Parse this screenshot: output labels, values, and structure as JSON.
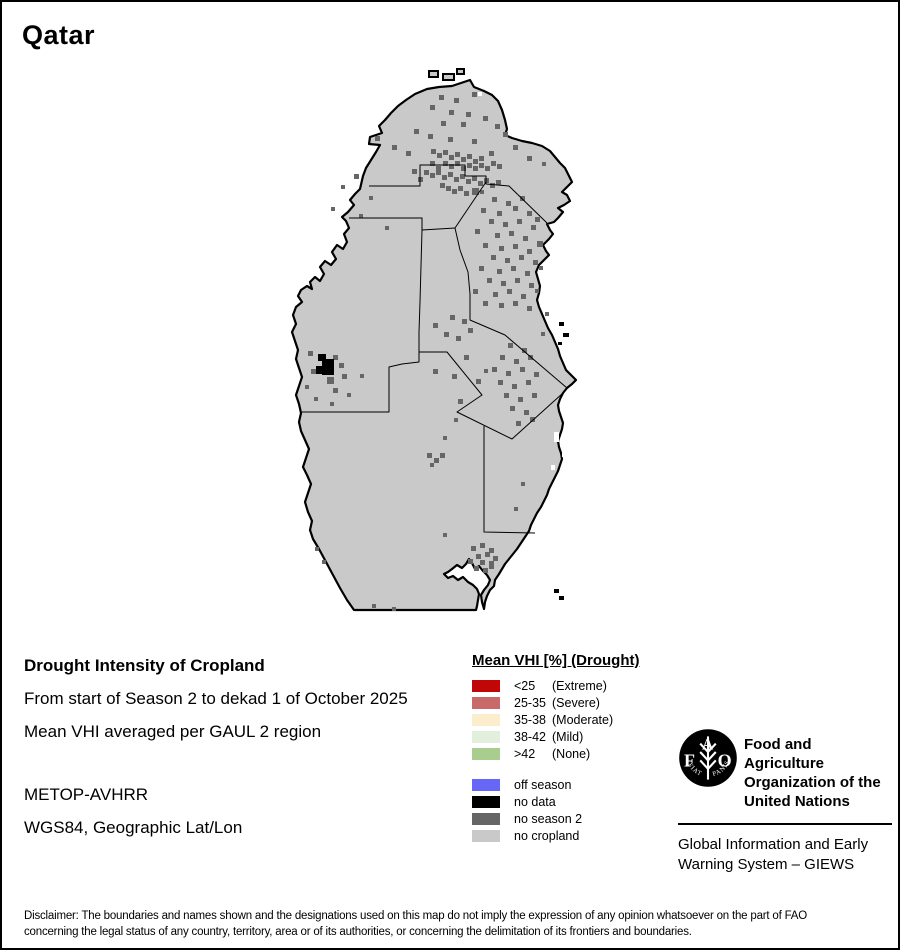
{
  "title": "Qatar",
  "info": {
    "heading": "Drought Intensity of Cropland",
    "line1": "From start of Season 2 to dekad 1 of October 2025",
    "line2": "Mean VHI averaged per GAUL 2 region",
    "line3": "METOP-AVHRR",
    "line4": "WGS84, Geographic Lat/Lon"
  },
  "legend": {
    "title": "Mean VHI [%] (Drought)",
    "drought_items": [
      {
        "value": "<25",
        "qualifier": "(Extreme)",
        "color": "#c00606"
      },
      {
        "value": "25-35",
        "qualifier": "(Severe)",
        "color": "#c96a6a"
      },
      {
        "value": "35-38",
        "qualifier": "(Moderate)",
        "color": "#fcedcc"
      },
      {
        "value": "38-42",
        "qualifier": "(Mild)",
        "color": "#e2efdc"
      },
      {
        "value": ">42",
        "qualifier": "(None)",
        "color": "#a9cc8f"
      }
    ],
    "status_items": [
      {
        "label": "off season",
        "color": "#6666f7"
      },
      {
        "label": "no data",
        "color": "#000000"
      },
      {
        "label": "no season 2",
        "color": "#666666"
      },
      {
        "label": "no cropland",
        "color": "#c9c9c9"
      }
    ]
  },
  "branding": {
    "org_name_lines": [
      "Food and Agriculture",
      "Organization of the",
      "United Nations"
    ],
    "giews_lines": [
      "Global Information and Early",
      "Warning System – GIEWS"
    ],
    "logo_letters": [
      "F",
      "A",
      "O"
    ],
    "logo_motto_left": "FIAT",
    "logo_motto_right": "PANIS"
  },
  "disclaimer": {
    "line1": "Disclaimer: The boundaries and names shown and the designations used on this map do not imply the expression of any opinion whatsoever on the part of FAO",
    "line2": "concerning the legal status of any country, territory, area or of its authorities, or concerning the delimitation of its frontiers and boundaries."
  },
  "map": {
    "colors": {
      "land": "#c9c9c9",
      "border": "#000000",
      "region_line": "#000000",
      "no_season2": "#666666",
      "no_data": "#000000",
      "water_gap": "#ffffff"
    },
    "outline": "M437,85 L450,84 462,80 468,78 472,85 482,89 490,93 496,99 500,108 503,118 505,127 503,133 510,136 520,139 530,141 540,144 548,149 553,155 558,161 563,166 567,174 570,180 565,185 560,190 565,193 568,199 562,203 556,206 561,210 556,216 552,220 545,222 548,228 551,232 547,237 541,243 544,249 547,253 542,258 537,263 534,270 536,277 538,284 537,291 535,298 537,305 540,312 543,319 546,326 550,333 553,340 556,347 558,354 561,361 564,368 570,374 574,378 570,382 565,386 561,391 558,397 556,403 557,409 559,415 561,421 560,427 558,433 556,439 557,445 559,451 560,457 558,463 556,469 553,475 550,481 547,487 545,493 542,499 539,505 535,511 532,517 529,523 527,529 523,535 519,541 515,547 511,552 507,557 503,562 500,567 497,572 493,578 492,584 488,588 485,594 483,600 482,607 480,600 479,593 482,588 486,583 488,578 485,573 481,569 477,564 473,567 470,561 467,557 464,562 460,566 455,563 450,567 446,570 442,572 446,576 451,574 456,578 461,575 466,580 471,583 475,587 477,592 476,598 475,604 474,608 352,608 345,598 338,586 331,573 324,560 317,547 311,537 308,528 310,519 306,510 303,500 306,491 309,482 305,473 301,465 304,456 307,447 303,438 299,429 297,420 299,411 297,402 294,393 297,384 300,375 297,366 294,357 296,348 293,339 290,330 294,322 291,313 294,305 300,300 296,294 299,288 305,284 310,287 308,280 313,275 318,279 322,272 318,265 323,259 329,263 334,257 330,250 335,243 341,247 345,240 342,232 347,226 344,219 340,215 346,210 352,203 348,198 353,192 358,187 361,174 364,166 369,158 374,150 378,143 367,142 368,135 380,131 377,124 383,118 389,111 396,104 404,98 413,92 425,87 Z",
    "boundaries": [
      "M367,184 L418,184 418,163 463,163 463,174 484,174 484,182 507,184 545,221",
      "M484,180 L453,226",
      "M347,216 L420,216 420,228 453,226",
      "M453,226 L458,248 466,270 468,292 468,318 503,333 565,386",
      "M420,228 L418,300 417,330 417,360 400,362 387,365 387,410 300,410",
      "M417,350 L445,350 480,393 455,410 510,437 561,391",
      "M482,424 L482,530 533,531"
    ],
    "speckles": [
      [
        437,
        93
      ],
      [
        452,
        96
      ],
      [
        470,
        90
      ],
      [
        428,
        103
      ],
      [
        447,
        108
      ],
      [
        464,
        110
      ],
      [
        481,
        114
      ],
      [
        439,
        119
      ],
      [
        459,
        120
      ],
      [
        493,
        122
      ],
      [
        412,
        127
      ],
      [
        426,
        132
      ],
      [
        501,
        130
      ],
      [
        373,
        134
      ],
      [
        446,
        135
      ],
      [
        470,
        137
      ],
      [
        511,
        143
      ],
      [
        390,
        143
      ],
      [
        404,
        149
      ],
      [
        487,
        149
      ],
      [
        525,
        154
      ],
      [
        540,
        160,
        4,
        4
      ],
      [
        352,
        172
      ],
      [
        339,
        183,
        4,
        4
      ],
      [
        367,
        194,
        4,
        4
      ],
      [
        329,
        205,
        4,
        4
      ],
      [
        357,
        212,
        4,
        4
      ],
      [
        383,
        224,
        4,
        4
      ],
      [
        429,
        147
      ],
      [
        435,
        151
      ],
      [
        441,
        148
      ],
      [
        447,
        153
      ],
      [
        453,
        150
      ],
      [
        459,
        155
      ],
      [
        465,
        152
      ],
      [
        471,
        157
      ],
      [
        477,
        154
      ],
      [
        441,
        159
      ],
      [
        447,
        162
      ],
      [
        453,
        159
      ],
      [
        459,
        164
      ],
      [
        465,
        161
      ],
      [
        434,
        164
      ],
      [
        428,
        159
      ],
      [
        471,
        164
      ],
      [
        477,
        161
      ],
      [
        483,
        164
      ],
      [
        489,
        159
      ],
      [
        495,
        162
      ],
      [
        422,
        168
      ],
      [
        428,
        171
      ],
      [
        434,
        168
      ],
      [
        440,
        173
      ],
      [
        446,
        170
      ],
      [
        452,
        175
      ],
      [
        458,
        172
      ],
      [
        464,
        177
      ],
      [
        470,
        174
      ],
      [
        476,
        179
      ],
      [
        482,
        176
      ],
      [
        488,
        181
      ],
      [
        494,
        178
      ],
      [
        438,
        181
      ],
      [
        444,
        184
      ],
      [
        450,
        187
      ],
      [
        456,
        184
      ],
      [
        462,
        189
      ],
      [
        416,
        175
      ],
      [
        410,
        167
      ],
      [
        470,
        186,
        7,
        7
      ],
      [
        478,
        188,
        4,
        4
      ],
      [
        490,
        195
      ],
      [
        504,
        199
      ],
      [
        518,
        194
      ],
      [
        479,
        206
      ],
      [
        495,
        209
      ],
      [
        511,
        204
      ],
      [
        525,
        209
      ],
      [
        533,
        215
      ],
      [
        487,
        217
      ],
      [
        501,
        220
      ],
      [
        515,
        217
      ],
      [
        529,
        223
      ],
      [
        473,
        227
      ],
      [
        493,
        231
      ],
      [
        507,
        229
      ],
      [
        521,
        234
      ],
      [
        535,
        239,
        6,
        6
      ],
      [
        481,
        241
      ],
      [
        497,
        244
      ],
      [
        511,
        242
      ],
      [
        525,
        247
      ],
      [
        489,
        253
      ],
      [
        503,
        256
      ],
      [
        517,
        253
      ],
      [
        531,
        258
      ],
      [
        477,
        264
      ],
      [
        495,
        267
      ],
      [
        509,
        264
      ],
      [
        523,
        269
      ],
      [
        537,
        264,
        4,
        4
      ],
      [
        485,
        276
      ],
      [
        499,
        279
      ],
      [
        513,
        276
      ],
      [
        527,
        281
      ],
      [
        471,
        287
      ],
      [
        491,
        290
      ],
      [
        505,
        287
      ],
      [
        519,
        292
      ],
      [
        533,
        287,
        4,
        4
      ],
      [
        481,
        299
      ],
      [
        497,
        301
      ],
      [
        511,
        299
      ],
      [
        525,
        304
      ],
      [
        448,
        313
      ],
      [
        460,
        317
      ],
      [
        431,
        321
      ],
      [
        466,
        326
      ],
      [
        442,
        330
      ],
      [
        454,
        334
      ],
      [
        506,
        341
      ],
      [
        520,
        346
      ],
      [
        498,
        353
      ],
      [
        512,
        357
      ],
      [
        526,
        353
      ],
      [
        490,
        365
      ],
      [
        504,
        369
      ],
      [
        518,
        365
      ],
      [
        532,
        370
      ],
      [
        496,
        378
      ],
      [
        510,
        382
      ],
      [
        524,
        378
      ],
      [
        502,
        391
      ],
      [
        516,
        395
      ],
      [
        530,
        391
      ],
      [
        508,
        404
      ],
      [
        522,
        408
      ],
      [
        462,
        353
      ],
      [
        474,
        377
      ],
      [
        456,
        397
      ],
      [
        514,
        419
      ],
      [
        528,
        415
      ],
      [
        539,
        330,
        4,
        4
      ],
      [
        543,
        310,
        4,
        4
      ],
      [
        306,
        349
      ],
      [
        331,
        353
      ],
      [
        337,
        361
      ],
      [
        309,
        367
      ],
      [
        325,
        375,
        7,
        7
      ],
      [
        340,
        372
      ],
      [
        303,
        383,
        4,
        4
      ],
      [
        331,
        386
      ],
      [
        345,
        391,
        4,
        4
      ],
      [
        312,
        395,
        4,
        4
      ],
      [
        328,
        400,
        4,
        4
      ],
      [
        358,
        372,
        4,
        4
      ],
      [
        431,
        367
      ],
      [
        450,
        372
      ],
      [
        482,
        367,
        4,
        4
      ],
      [
        425,
        451
      ],
      [
        432,
        456
      ],
      [
        438,
        451
      ],
      [
        428,
        461,
        4,
        4
      ],
      [
        441,
        434,
        4,
        4
      ],
      [
        452,
        416,
        4,
        4
      ],
      [
        441,
        531,
        4,
        4
      ],
      [
        512,
        505,
        4,
        4
      ],
      [
        519,
        480,
        4,
        4
      ],
      [
        469,
        544
      ],
      [
        478,
        541
      ],
      [
        487,
        546
      ],
      [
        474,
        552
      ],
      [
        483,
        550
      ],
      [
        491,
        554
      ],
      [
        466,
        557
      ],
      [
        478,
        558
      ],
      [
        487,
        559
      ],
      [
        472,
        564
      ],
      [
        481,
        566
      ],
      [
        487,
        562
      ],
      [
        320,
        558,
        4,
        4
      ],
      [
        313,
        545,
        4,
        4
      ],
      [
        370,
        602,
        4,
        4
      ],
      [
        390,
        605,
        4,
        4
      ]
    ],
    "no_data_cells": [
      [
        316,
        352,
        8,
        7
      ],
      [
        320,
        357,
        12,
        16
      ],
      [
        314,
        364,
        6,
        8
      ]
    ],
    "water_gaps": [
      [
        552,
        430,
        5,
        10
      ],
      [
        560,
        447,
        5,
        8
      ],
      [
        566,
        420,
        4,
        6
      ],
      [
        570,
        455,
        4,
        8
      ],
      [
        549,
        463,
        4,
        5
      ],
      [
        500,
        96,
        4,
        4
      ],
      [
        476,
        90,
        4,
        4
      ]
    ],
    "islands": [
      [
        427,
        69,
        9,
        6
      ],
      [
        441,
        72,
        11,
        6
      ],
      [
        455,
        67,
        7,
        5
      ]
    ],
    "islets": [
      [
        557,
        320,
        5,
        4
      ],
      [
        561,
        331,
        6,
        4
      ],
      [
        556,
        340,
        4,
        3
      ],
      [
        552,
        587,
        5,
        4
      ],
      [
        557,
        594,
        5,
        4
      ]
    ]
  }
}
